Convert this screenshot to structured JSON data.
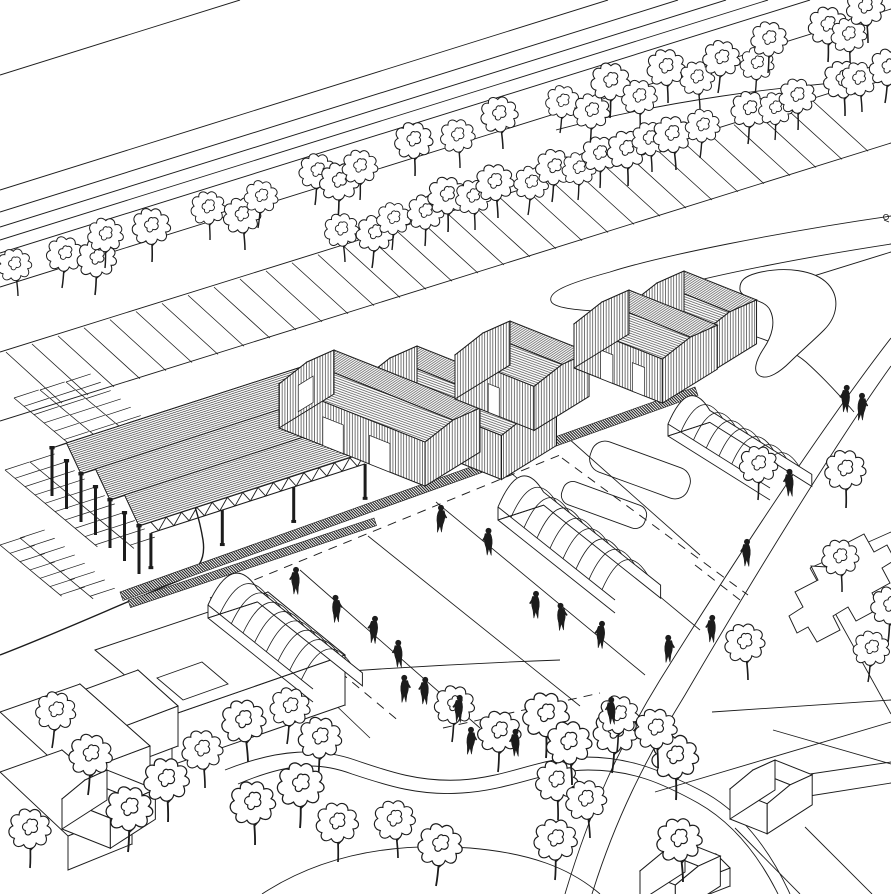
{
  "meta": {
    "description": "Black and white axonometric architectural site drawing: railway corridor with tree rows, open truss canopy shed, three hatched-roof warehouses, quonset huts, field strips with pedestrians, winding tree-lined paths and outline houses"
  },
  "palette": {
    "ink": "#1c1c1c",
    "paper": "#ffffff"
  },
  "railway": {
    "lines": [
      [
        0,
        75,
        240,
        0
      ],
      [
        0,
        190,
        608,
        0
      ],
      [
        0,
        212,
        678,
        0
      ],
      [
        0,
        227,
        726,
        0
      ],
      [
        0,
        240,
        768,
        0
      ],
      [
        0,
        253,
        810,
        0
      ],
      [
        0,
        287,
        891,
        9
      ],
      [
        0,
        352,
        891,
        74
      ],
      [
        0,
        421,
        891,
        143
      ],
      [
        620,
        336,
        891,
        252
      ]
    ],
    "verge": {
      "y0": 352,
      "slope": 0.3125,
      "tick_dx": 56,
      "tick_dy": 51,
      "step": 26,
      "x_from": 6,
      "x_to": 812
    },
    "top_curve": "M 556,130 C 660,102 780,85 891,79"
  },
  "roads": {
    "solid": [
      "M 891,216 C 780,232 660,256 610,272 C 566,284 548,292 551,301 C 554,312 606,310 662,317 C 726,325 780,340 806,362 C 826,380 842,398 854,412",
      "M 891,244 C 800,258 720,274 672,287 C 649,293 636,298 637,303 C 638,310 664,310 700,316",
      "M 891,338 C 820,430 735,560 660,680 C 620,745 590,810 565,894",
      "M 891,366 C 838,440 755,575 685,695 C 645,760 615,820 592,894",
      "M 225,770 C 280,748 320,748 355,760 C 390,772 420,782 460,780 C 510,777 540,757 585,757 C 630,757 660,770 700,790 C 740,810 770,850 790,894",
      "M 238,784 C 290,762 320,762 352,774 C 388,786 420,796 462,793 C 512,790 545,770 588,770 C 632,770 662,783 698,803 C 735,824 760,858 778,894",
      "M 262,894 C 320,856 390,842 470,848 C 530,853 570,868 600,894",
      "M 200,683 C 320,672 450,664 560,660",
      "M 655,792 L 891,722",
      "M 712,712 L 891,700",
      "M 773,730 L 891,764",
      "M 783,778 L 891,762",
      "M 891,532 L 810,568",
      "M 810,568 L 891,714",
      "M 803,797 L 891,783",
      "M 805,827 L 872,894",
      "M 735,828 L 800,894"
    ],
    "dashed": [
      [
        210,
        598,
        560,
        455
      ],
      [
        562,
        458,
        748,
        595
      ],
      [
        340,
        672,
        400,
        722
      ],
      [
        443,
        728,
        600,
        693
      ],
      [
        695,
        565,
        740,
        600
      ]
    ],
    "field_lines": [
      [
        232,
        606,
        370,
        738
      ],
      [
        300,
        570,
        480,
        728
      ],
      [
        368,
        536,
        580,
        706
      ],
      [
        436,
        502,
        645,
        675
      ],
      [
        505,
        468,
        700,
        630
      ],
      [
        568,
        438,
        700,
        555
      ]
    ]
  },
  "walkways": [
    {
      "x1": 120,
      "y1": 592,
      "x2": 695,
      "y2": 387,
      "w": 9
    },
    {
      "x1": 128,
      "y1": 600,
      "x2": 374,
      "y2": 518,
      "w": 8
    }
  ],
  "parking": {
    "boundary": "M 148,424 C 175,452 196,497 203,540 C 206,560 198,572 178,581 C 130,600 60,632 0,655",
    "rows": [
      [
        14,
        398,
        150
      ],
      [
        40,
        390,
        160
      ],
      [
        66,
        382,
        170
      ],
      [
        5,
        470,
        120
      ],
      [
        30,
        462,
        135
      ],
      [
        0,
        545,
        80
      ],
      [
        20,
        538,
        95
      ]
    ],
    "tick_len": 26,
    "step": 13
  },
  "canopy": {
    "x": 52,
    "y": 448,
    "u": [
      238,
      -77
    ],
    "v": [
      87,
      78
    ],
    "bays": 3,
    "ridge_h": 18,
    "col_h": 42
  },
  "geom": {
    "ridge": [
      0.93,
      0.37
    ],
    "big": {
      "esw": [
        -28,
        22
      ],
      "ene": [
        27,
        -12
      ],
      "wd": 44
    },
    "small": {
      "esw": [
        -23,
        19
      ],
      "ene": [
        22,
        -10
      ],
      "wd": 30
    }
  },
  "buildings": [
    {
      "name": "warehouse-a",
      "size": "big",
      "clad": true,
      "doors": [
        0.3,
        0.62
      ],
      "nw_door": true,
      "volumes": [
        {
          "px": 390,
          "py": 358,
          "len": 150
        },
        {
          "px": 307,
          "py": 362,
          "len": 157
        }
      ]
    },
    {
      "name": "warehouse-b",
      "size": "big",
      "clad": true,
      "doors": [
        0.42
      ],
      "nw_door": false,
      "volumes": [
        {
          "px": 483,
          "py": 333,
          "len": 85
        }
      ]
    },
    {
      "name": "warehouse-c",
      "size": "big",
      "clad": true,
      "doors": [
        0.3,
        0.66
      ],
      "nw_door": false,
      "volumes": [
        {
          "px": 657,
          "py": 283,
          "len": 78
        },
        {
          "px": 602,
          "py": 302,
          "len": 95
        }
      ]
    },
    {
      "name": "house-1",
      "size": "small",
      "clad": false,
      "doors": [],
      "nw_door": false,
      "volumes": [
        {
          "px": 753,
          "py": 770,
          "len": 40
        }
      ]
    },
    {
      "name": "house-2",
      "size": "small",
      "clad": false,
      "doors": [],
      "nw_door": false,
      "volumes": [
        {
          "px": 663,
          "py": 852,
          "len": 38
        }
      ]
    },
    {
      "name": "house-3",
      "size": "small",
      "clad": false,
      "doors": [],
      "nw_door": false,
      "volumes": [
        {
          "px": 85,
          "py": 780,
          "len": 52
        }
      ]
    }
  ],
  "huts": [
    {
      "name": "quonset-1",
      "x": 208,
      "y": 618,
      "w": 52,
      "vx": 105,
      "vy": 84,
      "h": 13,
      "rise": 22,
      "ribs": 8
    },
    {
      "name": "quonset-2",
      "x": 498,
      "y": 520,
      "w": 48,
      "vx": 117,
      "vy": 93,
      "h": 13,
      "rise": 22,
      "ribs": 8
    },
    {
      "name": "quonset-3",
      "x": 668,
      "y": 436,
      "w": 44,
      "vx": 102,
      "vy": 64,
      "h": 12,
      "rise": 20,
      "ribs": 7
    }
  ],
  "prisms": [
    {
      "top": [
        [
          95,
          650
        ],
        [
          268,
          592
        ],
        [
          345,
          655
        ],
        [
          172,
          715
        ]
      ],
      "drop": 50
    },
    {
      "top": [
        [
          56,
          700
        ],
        [
          138,
          670
        ],
        [
          178,
          706
        ],
        [
          96,
          737
        ]
      ],
      "drop": 40
    },
    {
      "top": [
        [
          0,
          712
        ],
        [
          80,
          684
        ],
        [
          150,
          746
        ],
        [
          70,
          776
        ]
      ],
      "drop": 38
    },
    {
      "top": [
        [
          0,
          772
        ],
        [
          62,
          750
        ],
        [
          132,
          810
        ],
        [
          68,
          836
        ]
      ],
      "drop": 34
    },
    {
      "top": [
        [
          693,
          862
        ],
        [
          716,
          854
        ],
        [
          730,
          868
        ],
        [
          707,
          877
        ]
      ],
      "drop": 18
    }
  ],
  "flats": [
    [
      [
        157,
        678
      ],
      [
        202,
        662
      ],
      [
        228,
        684
      ],
      [
        183,
        700
      ]
    ]
  ],
  "landscape": {
    "blob": "M 757,273 C 785,266 815,270 828,284 C 840,297 838,316 824,330 C 812,342 800,352 790,362 C 780,372 768,380 760,376 C 752,372 756,360 764,348 C 772,336 776,322 770,310 C 764,298 742,300 740,290 C 739,280 746,276 757,273 Z",
    "rounded": [
      {
        "cx": 640,
        "cy": 470,
        "w": 104,
        "h": 32,
        "r": 14,
        "rot": 20
      },
      {
        "cx": 604,
        "cy": 505,
        "w": 88,
        "h": 24,
        "r": 10,
        "rot": 20
      }
    ],
    "plus_building": "M 827,567 L 846,557 L 841,546 L 864,534 L 874,552 L 887,545 L 895,560 L 882,568 L 890,583 L 872,593 L 880,608 L 856,621 L 848,607 L 833,616 L 840,630 L 817,642 L 808,627 L 797,633 L 789,616 L 803,607 L 795,592 L 818,580 L 811,566 Z",
    "glyph": [
      886,
      217
    ]
  },
  "trees": {
    "top": [
      [
        18,
        296
      ],
      [
        62,
        288
      ],
      [
        95,
        295
      ],
      [
        105,
        268
      ],
      [
        152,
        262
      ],
      [
        210,
        240
      ],
      [
        245,
        250
      ],
      [
        258,
        228
      ],
      [
        315,
        205
      ],
      [
        338,
        218
      ],
      [
        360,
        200
      ],
      [
        415,
        176
      ],
      [
        460,
        168
      ],
      [
        503,
        149
      ],
      [
        560,
        133
      ],
      [
        590,
        145
      ],
      [
        610,
        118
      ],
      [
        640,
        130
      ],
      [
        668,
        103
      ],
      [
        700,
        110
      ],
      [
        718,
        93
      ],
      [
        755,
        95
      ],
      [
        768,
        73
      ],
      [
        828,
        62
      ],
      [
        850,
        68
      ],
      [
        868,
        43
      ],
      [
        345,
        262
      ],
      [
        372,
        268
      ],
      [
        392,
        250
      ],
      [
        425,
        246
      ],
      [
        448,
        232
      ],
      [
        475,
        230
      ],
      [
        498,
        218
      ],
      [
        528,
        215
      ],
      [
        552,
        202
      ],
      [
        578,
        200
      ],
      [
        600,
        188
      ],
      [
        628,
        186
      ],
      [
        652,
        172
      ],
      [
        676,
        170
      ],
      [
        700,
        158
      ],
      [
        748,
        144
      ],
      [
        775,
        140
      ],
      [
        798,
        130
      ],
      [
        845,
        116
      ],
      [
        862,
        112
      ],
      [
        885,
        103
      ]
    ],
    "bottom": [
      [
        52,
        748
      ],
      [
        88,
        795
      ],
      [
        128,
        852
      ],
      [
        30,
        868
      ],
      [
        168,
        822
      ],
      [
        205,
        788
      ],
      [
        248,
        762
      ],
      [
        287,
        744
      ],
      [
        318,
        778
      ],
      [
        300,
        828
      ],
      [
        338,
        862
      ],
      [
        255,
        845
      ],
      [
        398,
        858
      ],
      [
        436,
        886
      ],
      [
        452,
        742
      ],
      [
        498,
        772
      ],
      [
        546,
        758
      ],
      [
        558,
        820
      ],
      [
        572,
        785
      ],
      [
        590,
        838
      ],
      [
        612,
        773
      ],
      [
        617,
        752
      ],
      [
        555,
        880
      ],
      [
        676,
        800
      ],
      [
        658,
        768
      ],
      [
        683,
        882
      ]
    ],
    "road": [
      [
        758,
        500
      ],
      [
        846,
        508
      ],
      [
        842,
        592
      ],
      [
        748,
        680
      ],
      [
        868,
        682
      ],
      [
        888,
        642
      ]
    ]
  },
  "people": [
    [
      440,
      522
    ],
    [
      489,
      545
    ],
    [
      296,
      584
    ],
    [
      336,
      612
    ],
    [
      374,
      633
    ],
    [
      399,
      657
    ],
    [
      404,
      692
    ],
    [
      425,
      694
    ],
    [
      459,
      712
    ],
    [
      470,
      744
    ],
    [
      516,
      746
    ],
    [
      536,
      608
    ],
    [
      561,
      620
    ],
    [
      601,
      638
    ],
    [
      612,
      714
    ],
    [
      668,
      652
    ],
    [
      712,
      632
    ],
    [
      846,
      402
    ],
    [
      861,
      410
    ],
    [
      790,
      486
    ],
    [
      747,
      556
    ]
  ]
}
